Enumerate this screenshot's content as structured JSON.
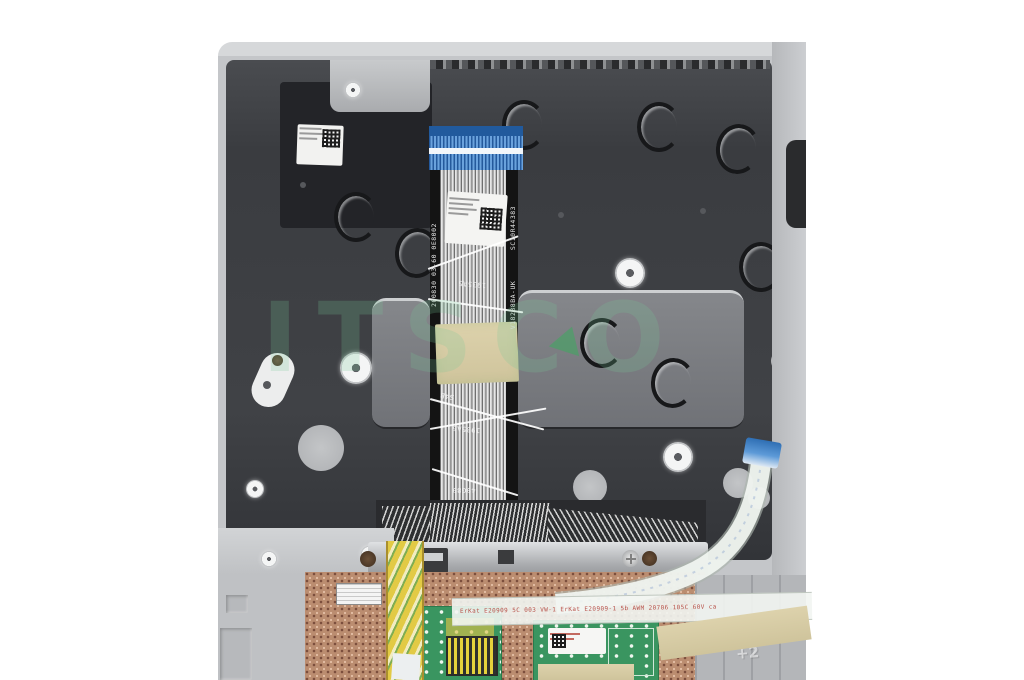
{
  "watermark": {
    "text": "ITSCO",
    "logo": "green-triangle",
    "color": "#78c896"
  },
  "keyboard_cable": {
    "side_code_left": "200830 03-60 0E8002",
    "side_code_right_top": "SC10R44383",
    "side_code_right_bottom": "V18288BA-UK",
    "print_codes": [
      "1935A5",
      "S4B",
      "1935A5",
      "49G89"
    ]
  },
  "touchpad_module": {
    "flex_text": "ErKat E20909   5C 003 VW-1   ErKat E20909-1 5b AWM 20706 105C 60V ca",
    "emboss_mark": "+2"
  },
  "palette": {
    "chassis_gray": "#c4c6c9",
    "plate_dark": "#3c3e42",
    "connector_blue": "#4a8ad0",
    "pcb_green": "#3a9560",
    "copper_bracket": "#bb8d70",
    "kapton_tape": "#d8cda6",
    "flex_yellow": "#dcc13e",
    "flex_label_red": "#b8524a",
    "background": "#ffffff"
  }
}
